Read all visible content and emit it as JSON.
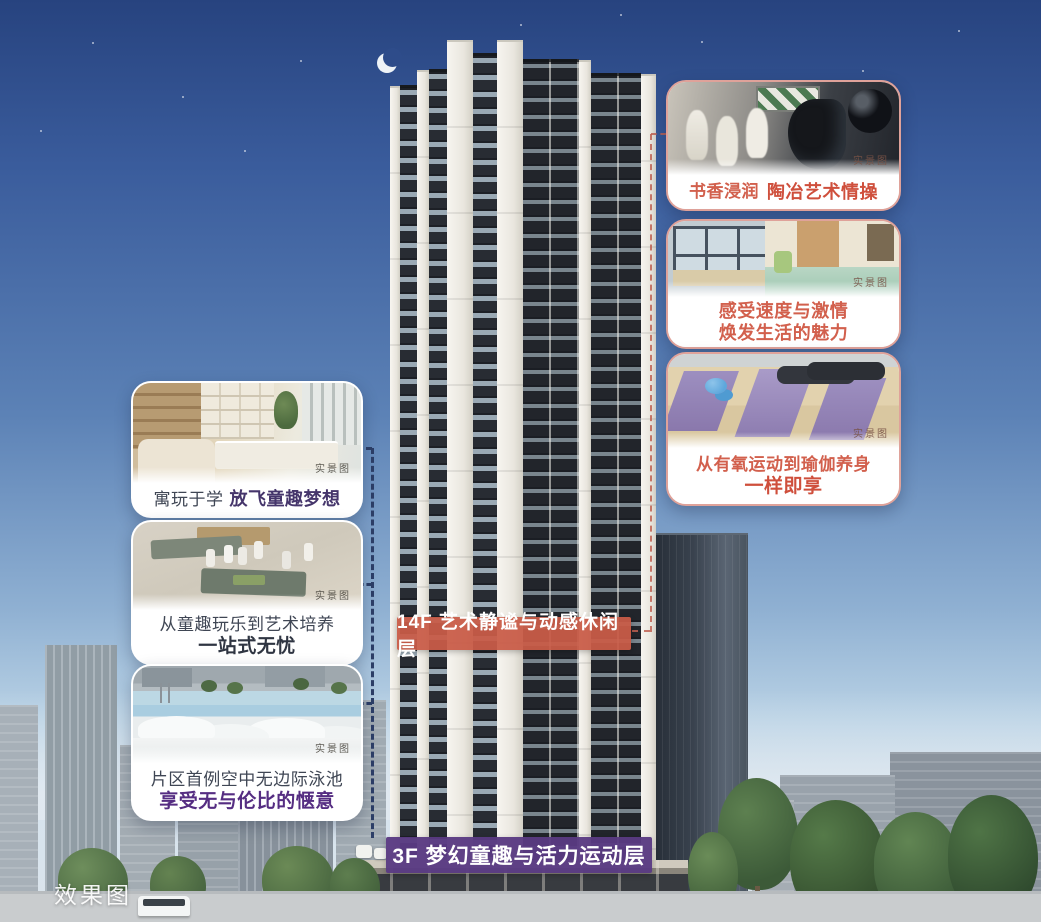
{
  "page": {
    "watermark": "效果图"
  },
  "colors": {
    "banner_orange": "#c95b47",
    "banner_purple": "#5a3a82",
    "caption_dark": "#3f4654",
    "caption_purple": "#552d82",
    "caption_red": "#d2604d",
    "connector_navy": "#2d3f68",
    "connector_red": "#bf6252",
    "sky_top": "#27437f",
    "sky_horizon": "#d6e3ee"
  },
  "banners": {
    "floor14": {
      "label": "14F 艺术静谧与动感休闲层"
    },
    "floor3": {
      "label": "3F 梦幻童趣与活力运动层"
    }
  },
  "cards": {
    "left": [
      {
        "line1": "寓玩于学",
        "line2": "放飞童趣梦想",
        "tag": "实景图",
        "photo": "study-room-photo"
      },
      {
        "line1": "从童趣玩乐到艺术培养",
        "line2": "一站式无忧",
        "tag": "实景图",
        "photo": "kids-art-table-photo"
      },
      {
        "line1": "片区首例空中无边际泳池",
        "line2": "享受无与伦比的惬意",
        "tag": "实景图",
        "photo": "infinity-pool-photo"
      }
    ],
    "right": [
      {
        "line1": "书香浸润",
        "line2": "陶冶艺术情操",
        "tag": "实景图",
        "photo": "chess-room-photo"
      },
      {
        "line1": "感受速度与激情",
        "line2": "焕发生活的魅力",
        "tag": "实景图",
        "photo": "activity-room-photo"
      },
      {
        "line1": "从有氧运动到瑜伽养身",
        "line2": "一样即享",
        "tag": "实景图",
        "photo": "yoga-room-photo"
      }
    ]
  }
}
